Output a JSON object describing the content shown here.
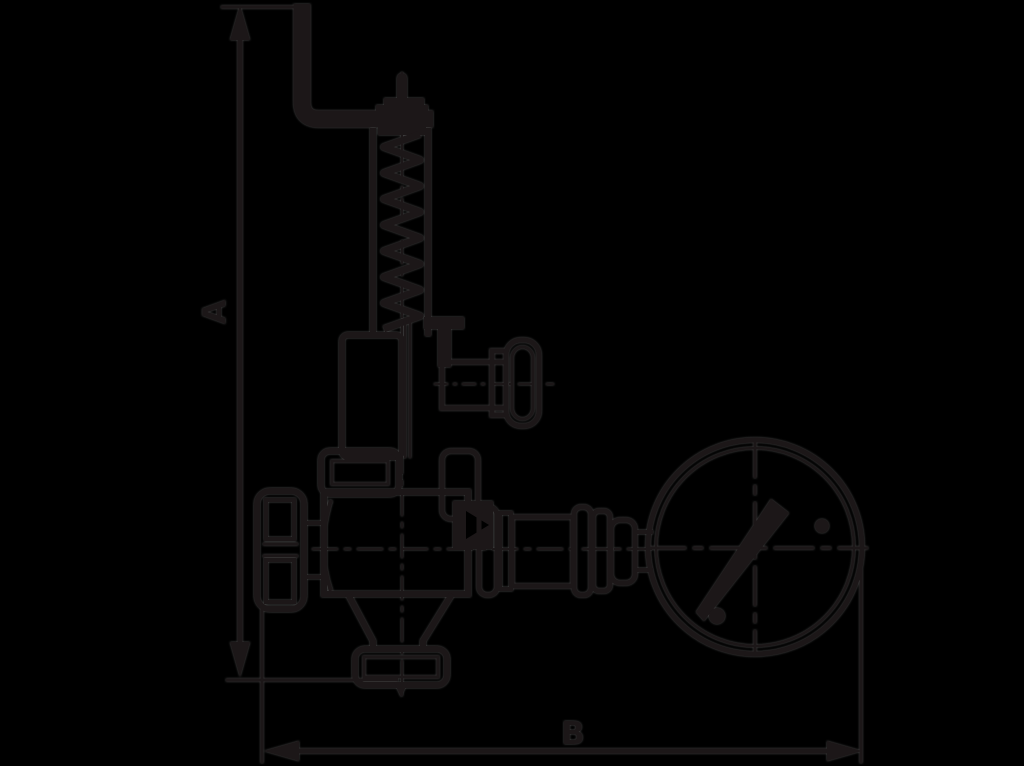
{
  "figure": {
    "kind": "dimension-drawing"
  },
  "dimensions": {
    "vertical": {
      "label": "A"
    },
    "horizontal": {
      "label": "B"
    }
  },
  "colors": {
    "background": "#000000",
    "ink": "#1c1718",
    "edge_fringe": "#969696"
  }
}
